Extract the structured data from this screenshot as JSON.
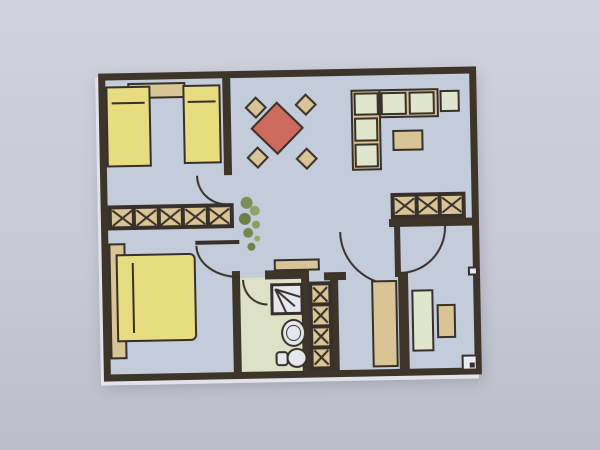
{
  "image": {
    "kind": "apartment floor plan, photographed print, no text labels"
  },
  "colors": {
    "background": "#c7c9d5",
    "background_top": "#d0d2dd",
    "wall": "#3e352a",
    "outline": "#38302a",
    "floor": "#c3ccdb",
    "bath_floor": "#dde2c6",
    "furniture_yellow": "#e7dc80",
    "furniture_tan": "#d8c494",
    "table_red": "#cf6a5f",
    "cushion_green": "#e0e6cd",
    "fixture_white": "#e4e7ed",
    "plant_green": "#7d8f55"
  },
  "plan": {
    "rooms": [
      {
        "name": "bedroom-top-left",
        "furniture": [
          "single-bed",
          "single-bed",
          "shelf",
          "wardrobe-5-cells"
        ]
      },
      {
        "name": "living-dining-room",
        "furniture": [
          "dining-table",
          "chair",
          "chair",
          "chair",
          "chair",
          "corner-sofa",
          "armchair",
          "coffee-table",
          "wardrobe-3-cells"
        ]
      },
      {
        "name": "bedroom-bottom-left",
        "furniture": [
          "double-bed",
          "headboard-strip"
        ]
      },
      {
        "name": "bathroom",
        "furniture": [
          "shower",
          "washbasin",
          "toilet",
          "cabinet"
        ]
      },
      {
        "name": "hallway",
        "furniture": [
          "plant",
          "tall-wardrobe",
          "closet-4-cells"
        ]
      },
      {
        "name": "room-bottom-right",
        "furniture": [
          "desk",
          "side-table"
        ]
      }
    ],
    "wardrobes": {
      "left_cells": 5,
      "right_cells": 3,
      "tall_cells": 4
    }
  }
}
